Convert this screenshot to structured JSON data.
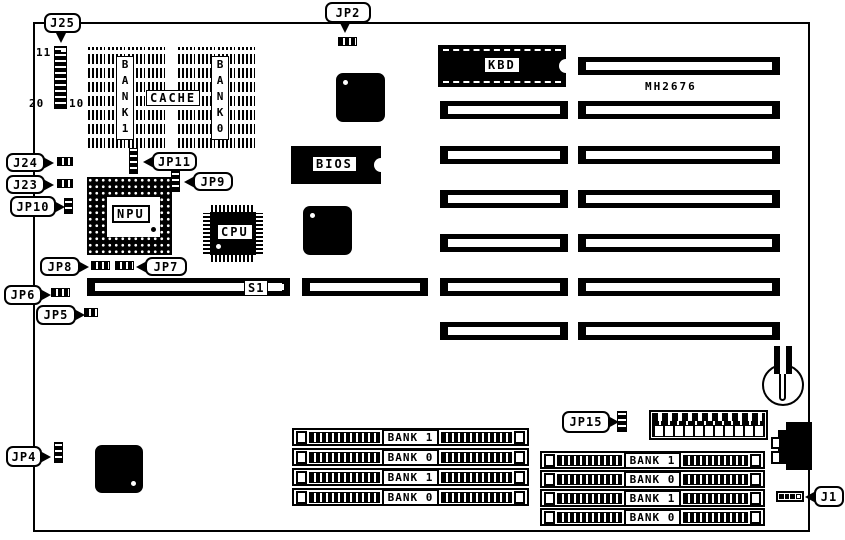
{
  "labels": {
    "j25": "J25",
    "jp2": "JP2",
    "j24": "J24",
    "j23": "J23",
    "jp10": "JP10",
    "jp11": "JP11",
    "jp9": "JP9",
    "jp8": "JP8",
    "jp7": "JP7",
    "jp6": "JP6",
    "jp5": "JP5",
    "jp4": "JP4",
    "jp15": "JP15",
    "j1": "J1"
  },
  "pins": {
    "j25_top": "11",
    "j25_bottom_left": "20",
    "j25_bottom_right": "10"
  },
  "chips": {
    "kbd": "KBD",
    "mh2676": "MH2676",
    "bios": "BIOS",
    "npu": "NPU",
    "cpu": "CPU",
    "cache": "CACHE",
    "cache_bank1": "BANK1",
    "cache_bank0": "BANK0",
    "s1": "S1"
  },
  "simm_left": {
    "rows": [
      {
        "label": "BANK 1"
      },
      {
        "label": "BANK 0"
      },
      {
        "label": "BANK 1"
      },
      {
        "label": "BANK 0"
      }
    ]
  },
  "simm_right": {
    "rows": [
      {
        "label": "BANK 1"
      },
      {
        "label": "BANK 0"
      },
      {
        "label": "BANK 1"
      },
      {
        "label": "BANK 0"
      }
    ]
  },
  "colors": {
    "line": "#000000",
    "background": "#ffffff"
  }
}
